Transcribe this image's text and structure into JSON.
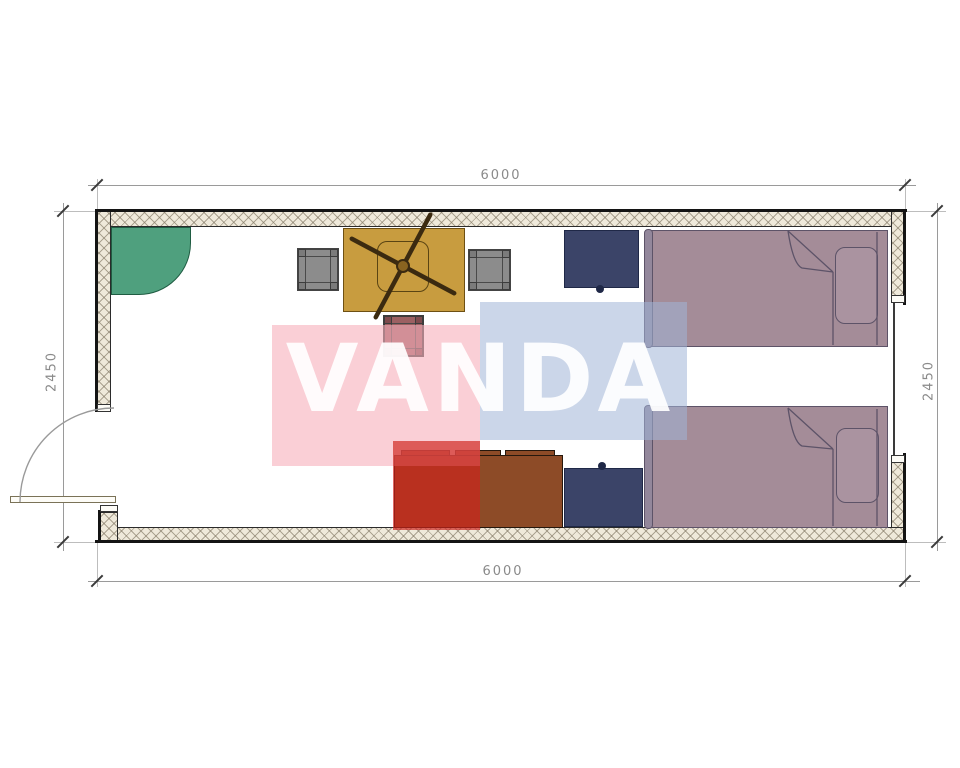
{
  "watermark": {
    "text": "VANDA"
  },
  "dimensions": {
    "top": "6000",
    "bottom": "6000",
    "left": "2450",
    "right": "2450"
  },
  "colors": {
    "wall_hatch": "#efe9da",
    "wall_line": "#141414",
    "dimension_text": "#8a8a8a",
    "corner_unit_green": "#4fa07e",
    "desk_tan": "#c89c3f",
    "chair_gray": "#8c8c8c",
    "stool_maroon": "#9c6062",
    "nightstand_navy": "#3b4468",
    "bed_mauve": "#a48c98",
    "sideboard_brown": "#8d4b27",
    "watermark_pink": "#f8ccd2",
    "watermark_blue": "#cad7e9",
    "watermark_red": "#d0463f"
  }
}
